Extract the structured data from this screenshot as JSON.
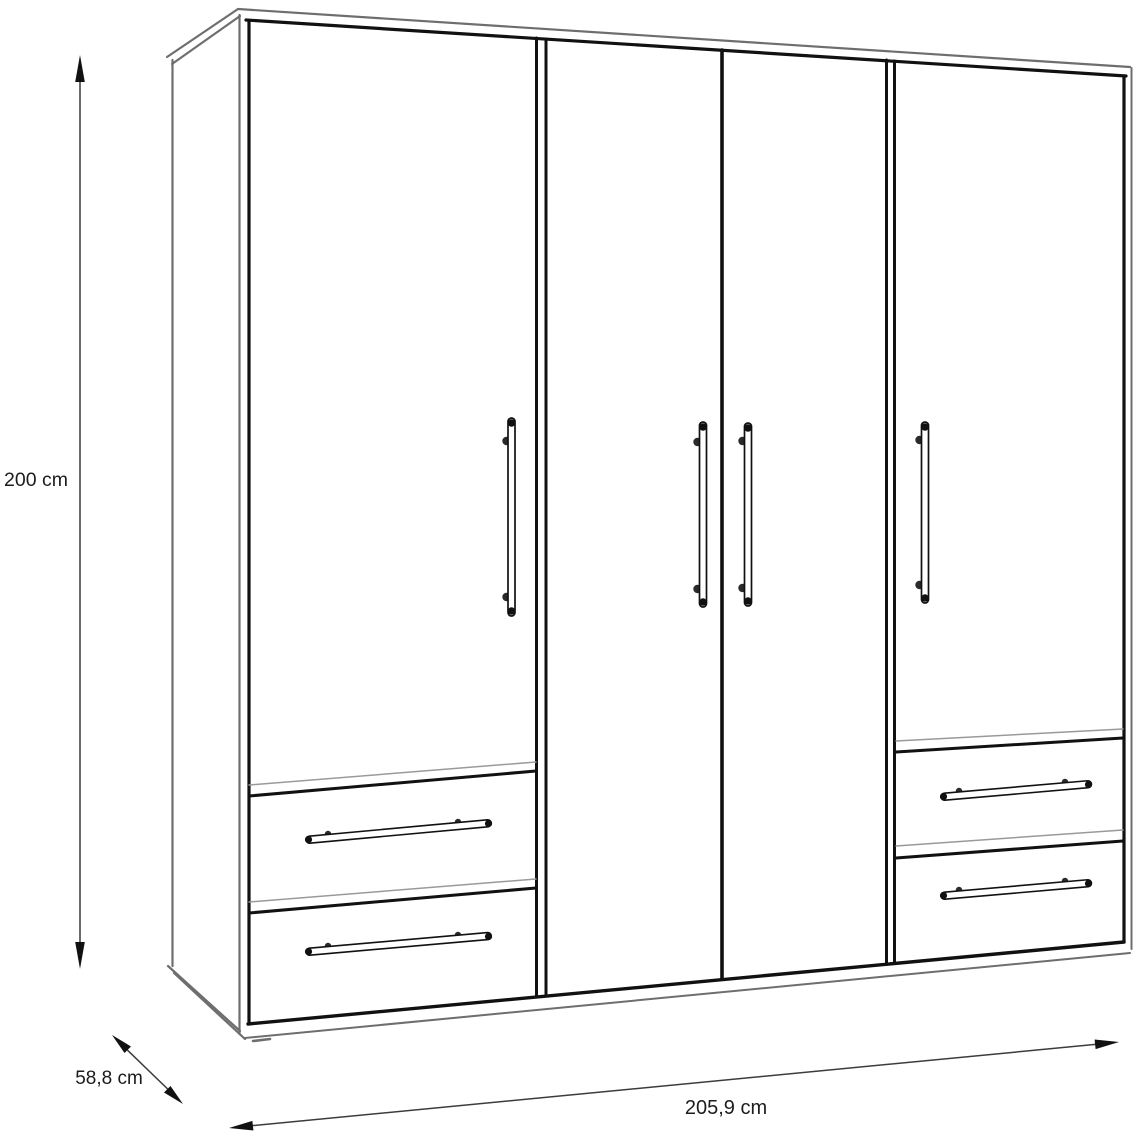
{
  "page": {
    "background": "#ffffff",
    "title": "Wardrobe dimension diagram"
  },
  "diagram": {
    "object": "four-door wardrobe with four lower drawers",
    "view": "front three-quarter technical line drawing",
    "colors": {
      "door_edge": "#111111",
      "carcass_edge": "#6e6e6e",
      "dimension_line": "#3c3c3c",
      "text": "#1c1c1c",
      "background": "#ffffff"
    },
    "labels": {
      "height": "200 cm",
      "depth": "58,8 cm",
      "width": "205,9 cm"
    },
    "counts": {
      "doors": 4,
      "door_handles": 4,
      "drawers": 4,
      "drawer_handles": 4
    }
  }
}
